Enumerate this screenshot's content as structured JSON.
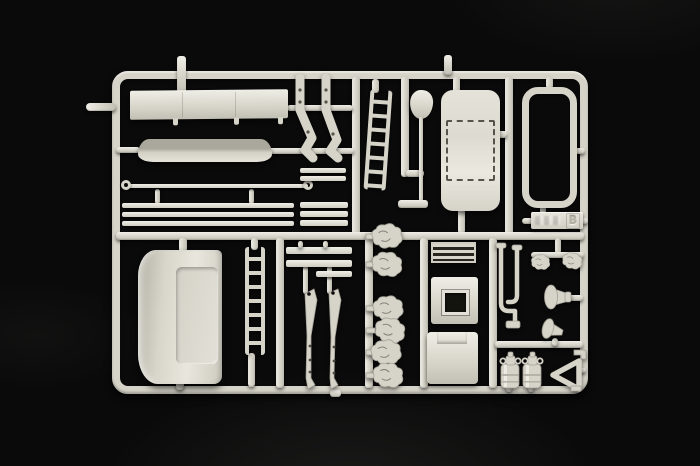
{
  "scene": {
    "type": "product-photo",
    "subject": "Photograph of a light grey injection-molded plastic model kit sprue (parts tree B) on a black background",
    "sprue_letter": "B"
  },
  "colors": {
    "bg": "#0a0a0a",
    "plastic": "#d6d4c8",
    "plastic-hi": "#efeee7",
    "plastic-mid": "#c2c0b4",
    "plastic-dark": "#a3a196",
    "plastic-deep": "#83817a",
    "recess": "#14140f",
    "spoiler-top": "#aaa89d"
  },
  "tag": {
    "letter": "B"
  },
  "parts": [
    {
      "id": "slat-fairing-panel",
      "label": "Long slatted fairing panel",
      "count": 1
    },
    {
      "id": "roof-spoiler",
      "label": "Curved spoiler strip",
      "count": 1
    },
    {
      "id": "grab-rail",
      "label": "Thin grab rail with eyelet ends",
      "count": 1
    },
    {
      "id": "trim-strips",
      "label": "Long trim strips",
      "count": 3
    },
    {
      "id": "step-bars",
      "label": "Short step bars",
      "count": 5
    },
    {
      "id": "mirror-arms",
      "label": "Bent mirror support arms",
      "count": 2
    },
    {
      "id": "ladder-small",
      "label": "Small access ladder",
      "count": 1
    },
    {
      "id": "mirror-paddle",
      "label": "Mirror head on long stalk with base",
      "count": 1
    },
    {
      "id": "cab-roof-panel",
      "label": "Cab roof panel with dashed sunroof outline",
      "count": 1
    },
    {
      "id": "window-frame",
      "label": "Rounded rectangular frame",
      "count": 1
    },
    {
      "id": "sprue-tag",
      "label": "Embossed identification tag",
      "count": 1
    },
    {
      "id": "cab-rear-panel",
      "label": "Large curved panel with recessed field",
      "count": 1
    },
    {
      "id": "ladder-large",
      "label": "Tall access ladder",
      "count": 1
    },
    {
      "id": "wiper-arms",
      "label": "Wiper-style lever arms",
      "count": 2
    },
    {
      "id": "crossmember-bars",
      "label": "Cross-member bars",
      "count": 3
    },
    {
      "id": "small-cast-parts",
      "label": "Small detailed cast parts",
      "count": 6
    },
    {
      "id": "vent-grille",
      "label": "Ribbed vent grille",
      "count": 1
    },
    {
      "id": "hatch-panel",
      "label": "Square hatch panel with opening",
      "count": 1
    },
    {
      "id": "storage-box-panel",
      "label": "Storage box panel with lid notch",
      "count": 1
    },
    {
      "id": "bent-pipes",
      "label": "Bent pipe pieces",
      "count": 2
    },
    {
      "id": "air-horns",
      "label": "Air horn pair",
      "count": 2
    },
    {
      "id": "horn-brackets",
      "label": "Horn / funnel brackets",
      "count": 2
    },
    {
      "id": "fire-extinguishers",
      "label": "Small cylindrical canisters",
      "count": 2
    },
    {
      "id": "warning-triangle",
      "label": "Hollow warning triangle",
      "count": 1
    },
    {
      "id": "corner-hook",
      "label": "Small L-shaped hook",
      "count": 1
    }
  ]
}
